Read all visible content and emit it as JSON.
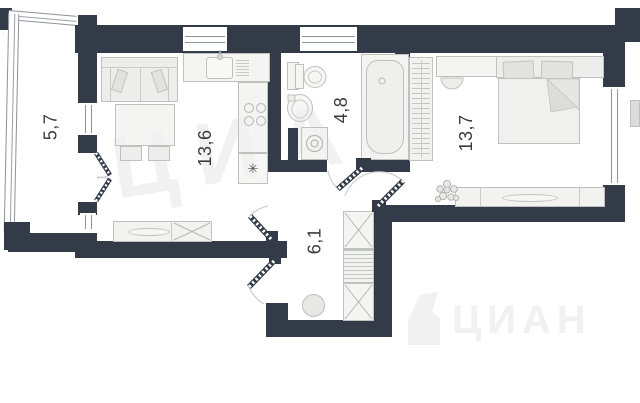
{
  "plan": {
    "rooms": [
      {
        "name": "balcony",
        "area_label": "5,7"
      },
      {
        "name": "living-room-with-kitchen",
        "area_label": "13,6"
      },
      {
        "name": "bathroom",
        "area_label": "4,8"
      },
      {
        "name": "bedroom",
        "area_label": "13,7"
      },
      {
        "name": "hallway",
        "area_label": "6,1"
      }
    ],
    "watermark": {
      "diagonal_text": "ЦИАН",
      "corner_text": "ЦИАН"
    },
    "icons": {
      "fridge": "✳"
    },
    "colors": {
      "wall": "#333a48",
      "furniture_outline": "#bfc1be",
      "furniture_fill": "#ededeb",
      "label_text": "#3b3b3b",
      "window_glazing": "#8d929b",
      "watermark": "#f1f1f1"
    }
  }
}
